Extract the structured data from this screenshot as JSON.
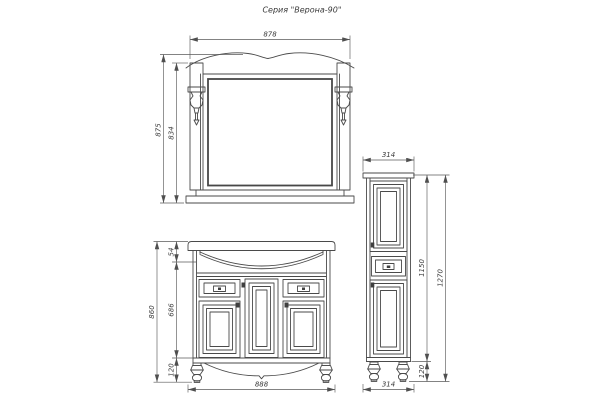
{
  "title": "Серия \"Верона-90\"",
  "colors": {
    "line": "#4a4a4a",
    "dim_line": "#5a5a5a",
    "text": "#3a3a3a",
    "background": "#ffffff"
  },
  "views": {
    "mirror": {
      "label": "mirror-front-view",
      "dims": {
        "width": "878",
        "height_total": "875",
        "height_frame": "834"
      }
    },
    "washbasin_cabinet": {
      "label": "washbasin-cabinet-front-view",
      "dims": {
        "width": "888",
        "height_total": "860",
        "top_height": "54",
        "body_height": "686",
        "leg_height": "120"
      }
    },
    "tall_cabinet": {
      "label": "tall-cabinet-front-view",
      "dims": {
        "width_top": "314",
        "width_bottom": "314",
        "body_height": "1150",
        "height_total": "1270",
        "leg_height": "120"
      }
    }
  }
}
